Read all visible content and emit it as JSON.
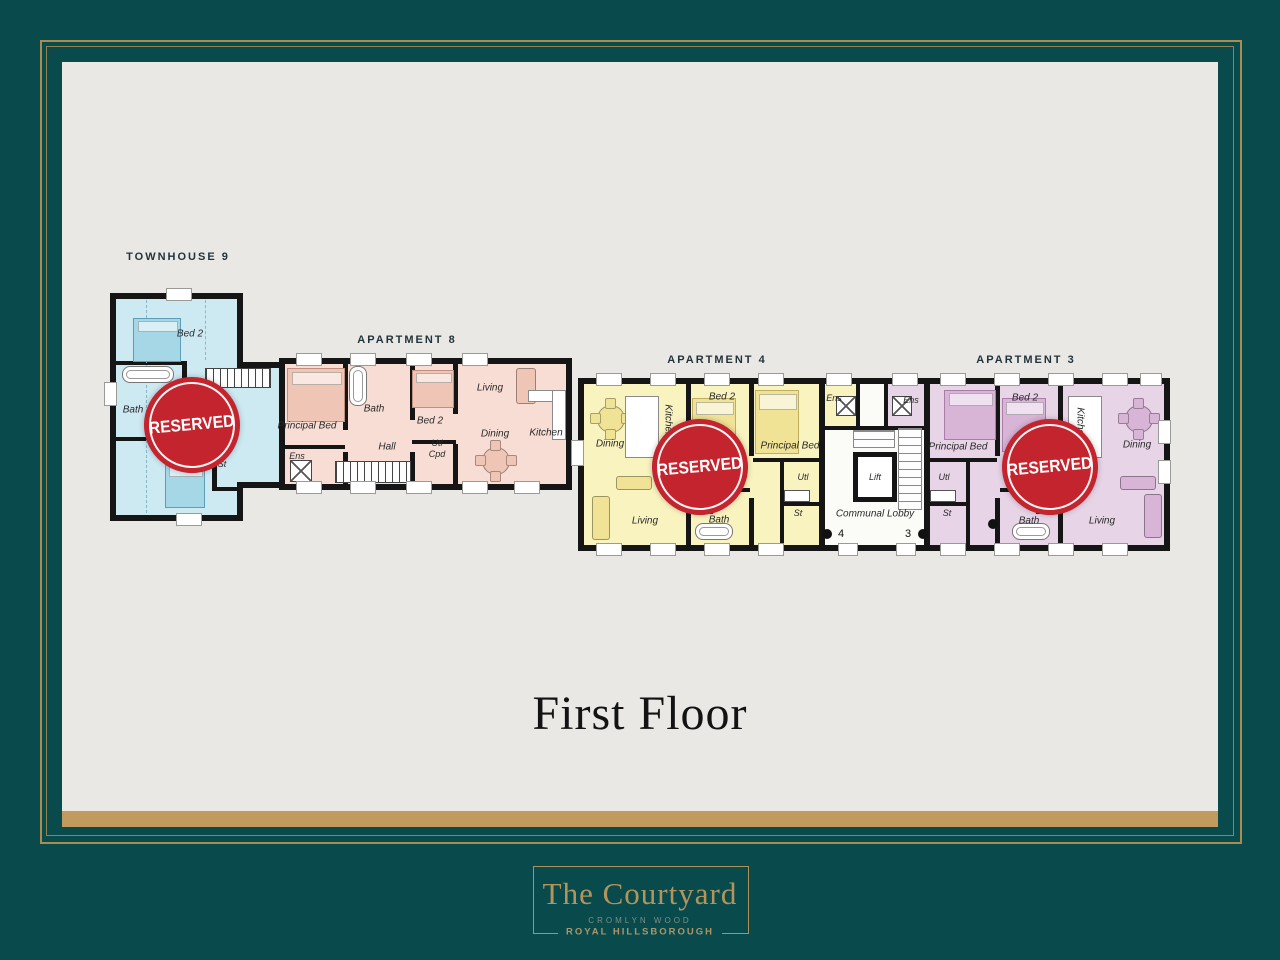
{
  "page": {
    "floor_title": "First Floor"
  },
  "footer": {
    "brand": "The Courtyard",
    "line1": "CROMLYN WOOD",
    "line2": "ROYAL HILLSBOROUGH"
  },
  "units": {
    "townhouse9": {
      "title": "TOWNHOUSE 9",
      "status": "RESERVED",
      "rooms": {
        "bed2": "Bed 2",
        "bath": "Bath",
        "bed3": "Bed 3",
        "st": "St"
      }
    },
    "apartment8": {
      "title": "APARTMENT 8",
      "rooms": {
        "principal_bed": "Principal Bed",
        "ens": "Ens",
        "bath": "Bath",
        "hall": "Hall",
        "bed2": "Bed 2",
        "utl": "Utl",
        "cpd": "Cpd",
        "living": "Living",
        "dining": "Dining",
        "kitchen": "Kitchen"
      }
    },
    "apartment4": {
      "title": "APARTMENT 4",
      "status": "RESERVED",
      "door_number": "4",
      "rooms": {
        "dining": "Dining",
        "kitchen": "Kitchen",
        "bed2": "Bed 2",
        "principal_bed": "Principal Bed",
        "ens": "Ens",
        "hall": "Hall",
        "bath": "Bath",
        "living": "Living",
        "utl": "Utl",
        "st": "St"
      }
    },
    "apartment3": {
      "title": "APARTMENT 3",
      "status": "RESERVED",
      "door_number": "3",
      "rooms": {
        "bed2": "Bed 2",
        "kitchen": "Kitchen",
        "dining": "Dining",
        "principal_bed": "Principal Bed",
        "ens": "Ens",
        "utl": "Utl",
        "st": "St",
        "hall": "Hall",
        "bath": "Bath",
        "living": "Living"
      }
    },
    "lobby": {
      "label": "Communal Lobby",
      "lift": "Lift"
    }
  },
  "colors": {
    "teal_background": "#094a4d",
    "gold": "#b3955c",
    "canvas_grey": "#e9e8e5",
    "reserved_red": "#c3242d",
    "townhouse_blue": "#cde9f2",
    "apartment8_pink": "#f7ddd3",
    "apartment4_yellow": "#f9f3c0",
    "apartment3_purple": "#e7d4e7",
    "lobby_white": "#fbfbf8"
  }
}
